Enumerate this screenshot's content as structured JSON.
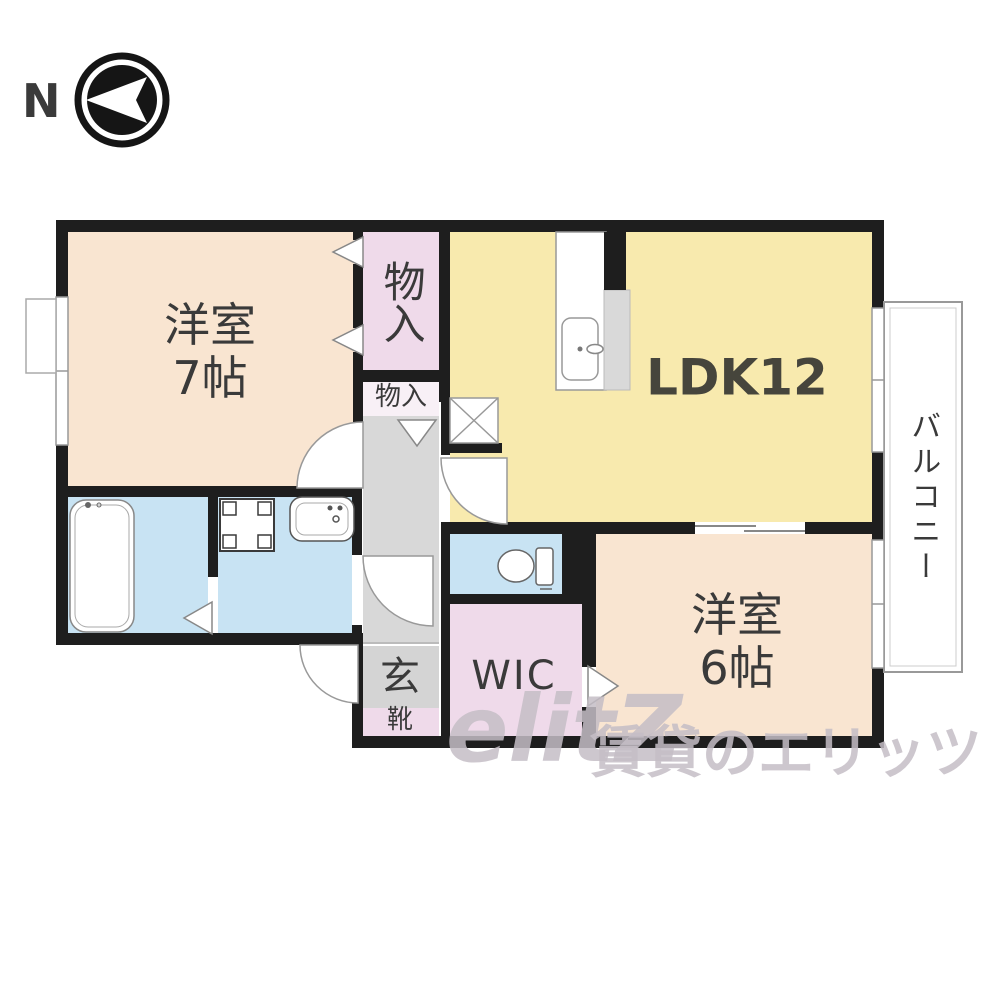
{
  "compass": {
    "north_label": "N"
  },
  "rooms": {
    "bedroom7": {
      "name": "洋室",
      "size": "7帖"
    },
    "ldk": {
      "label": "LDK12"
    },
    "closet_upper": {
      "label": "物入"
    },
    "closet_lower": {
      "label": "物入"
    },
    "balcony": {
      "label": "バルコニー"
    },
    "bedroom6": {
      "name": "洋室",
      "size": "6帖"
    },
    "wic": {
      "label": "WIC"
    },
    "entrance": {
      "label": "玄"
    },
    "shoe_cabinet": {
      "label": "靴"
    }
  },
  "watermark": {
    "logo": "elitZ",
    "text": "賃貸のエリッツ"
  },
  "colors": {
    "wall": "#1e1e1e",
    "bedroom_fill": "#f9e5d1",
    "ldk_fill": "#f8eaae",
    "closet_fill": "#efdaea",
    "wet_area_fill": "#c8e3f3",
    "hallway_fill": "#d8d8d8",
    "label_text": "#3a3a3a"
  }
}
